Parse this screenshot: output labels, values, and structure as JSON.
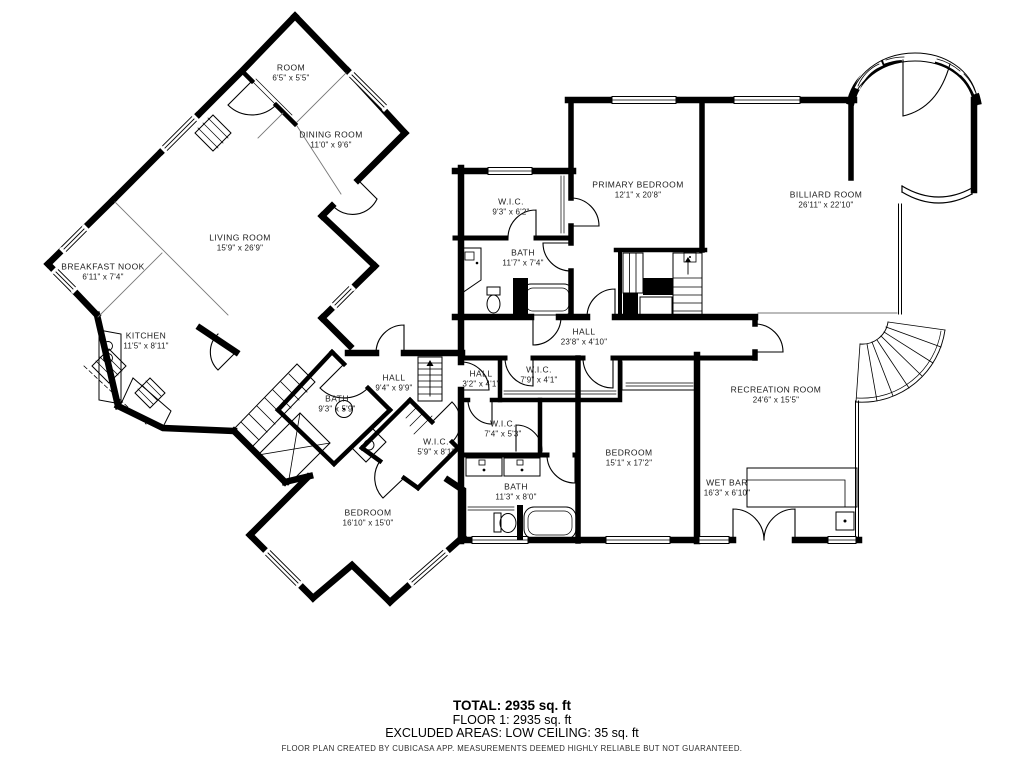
{
  "colors": {
    "walls": "#000000",
    "background": "#ffffff",
    "text": "#1b1b1b",
    "thin_line": "#777777"
  },
  "rooms": [
    {
      "name": "ROOM",
      "dims": "6'5\" x 5'5\""
    },
    {
      "name": "DINING ROOM",
      "dims": "11'0\" x 9'6\""
    },
    {
      "name": "LIVING ROOM",
      "dims": "15'9\" x 26'9\""
    },
    {
      "name": "BREAKFAST NOOK",
      "dims": "6'11\" x 7'4\""
    },
    {
      "name": "KITCHEN",
      "dims": "11'5\" x 8'11\""
    },
    {
      "name": "W.I.C.",
      "dims": "9'3\" x 6'2\""
    },
    {
      "name": "PRIMARY BEDROOM",
      "dims": "12'1\" x 20'8\""
    },
    {
      "name": "BILLIARD ROOM",
      "dims": "26'11\" x 22'10\""
    },
    {
      "name": "BATH",
      "dims": "11'7\" x 7'4\""
    },
    {
      "name": "HALL",
      "dims": "23'8\" x 4'10\""
    },
    {
      "name": "HALL",
      "dims": "9'4\" x 9'9\""
    },
    {
      "name": "HALL",
      "dims": "3'2\" x 4'1\""
    },
    {
      "name": "W.I.C.",
      "dims": "7'9\" x 4'1\""
    },
    {
      "name": "W.I.C.",
      "dims": "7'4\" x 5'3\""
    },
    {
      "name": "BATH",
      "dims": "9'3\" x 5'9\""
    },
    {
      "name": "W.I.C.",
      "dims": "5'9\" x 8'1\""
    },
    {
      "name": "RECREATION ROOM",
      "dims": "24'6\" x 15'5\""
    },
    {
      "name": "BEDROOM",
      "dims": "15'1\" x 17'2\""
    },
    {
      "name": "WET BAR",
      "dims": "16'3\" x 6'10\""
    },
    {
      "name": "BATH",
      "dims": "11'3\" x 8'0\""
    },
    {
      "name": "BEDROOM",
      "dims": "16'10\" x 15'0\""
    }
  ],
  "summary": {
    "total": "TOTAL: 2935 sq. ft",
    "floor1": "FLOOR 1: 2935 sq. ft",
    "excluded": "EXCLUDED AREAS: LOW CEILING: 35 sq. ft"
  },
  "disclaimer": "FLOOR PLAN CREATED BY CUBICASA APP. MEASUREMENTS DEEMED HIGHLY RELIABLE BUT NOT GUARANTEED."
}
